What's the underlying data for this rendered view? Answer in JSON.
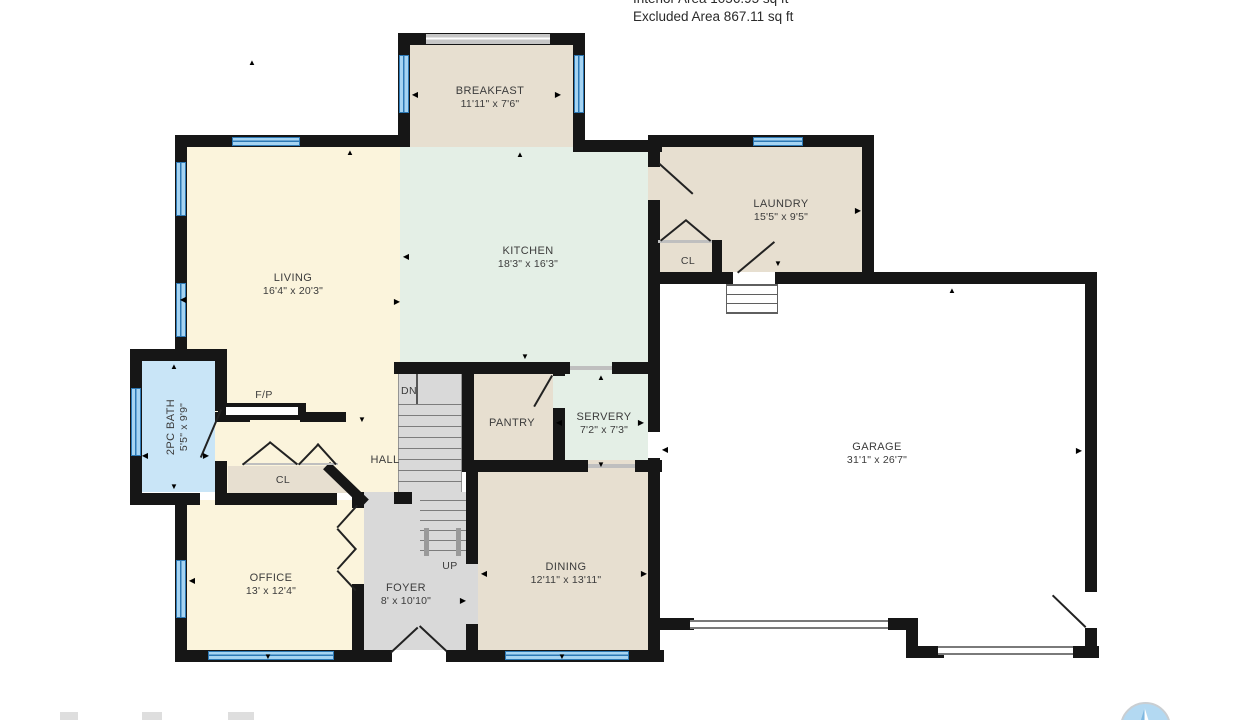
{
  "header": {
    "line1_clipped": "Interior Area 1056.95 sq ft",
    "line2": "Excluded Area 867.11 sq ft"
  },
  "rooms": {
    "breakfast": {
      "name": "BREAKFAST",
      "dims": "11'11\" x 7'6\""
    },
    "living": {
      "name": "LIVING",
      "dims": "16'4\" x 20'3\""
    },
    "kitchen": {
      "name": "KITCHEN",
      "dims": "18'3\" x 16'3\""
    },
    "laundry": {
      "name": "LAUNDRY",
      "dims": "15'5\" x 9'5\""
    },
    "laundry_closet": {
      "name": "CL"
    },
    "garage": {
      "name": "GARAGE",
      "dims": "31'1\" x 26'7\""
    },
    "pantry": {
      "name": "PANTRY"
    },
    "servery": {
      "name": "SERVERY",
      "dims": "7'2\" x 7'3\""
    },
    "bath": {
      "name": "2PC BATH",
      "dims": "5'5\" x 9'9\""
    },
    "hall": {
      "name": "HALL"
    },
    "hall_closet": {
      "name": "CL"
    },
    "office": {
      "name": "OFFICE",
      "dims": "13' x 12'4\""
    },
    "foyer": {
      "name": "FOYER",
      "dims": "8' x 10'10\""
    },
    "dining": {
      "name": "DINING",
      "dims": "12'11\" x 13'11\""
    },
    "fireplace": {
      "name": "F/P"
    }
  },
  "stairs": {
    "down": "DN",
    "up": "UP"
  },
  "colors": {
    "wall": "#161616",
    "living_yellow": "#fbf4dc",
    "room_tan": "#e7dfd0",
    "kitchen_green": "#e4efe6",
    "floor_gray": "#d9d9d9",
    "bath_blue": "#c9e5f7",
    "window_blue": "#a6d4f2",
    "window_line": "#2d79b5"
  },
  "footer": {
    "logo_icon": "iguide-compass-logo-icon"
  }
}
